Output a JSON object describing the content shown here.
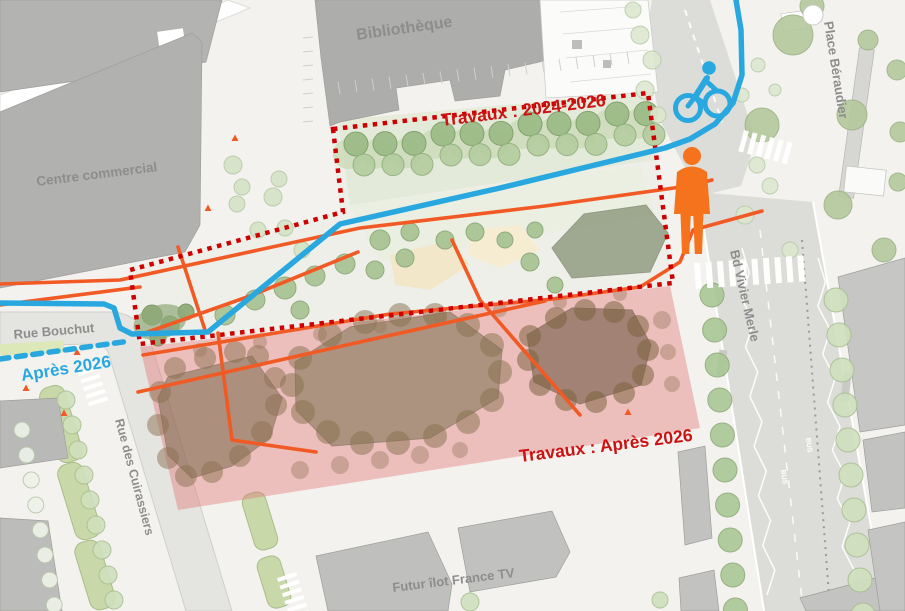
{
  "map": {
    "title": "Plan des travaux - secteur Part-Dieu",
    "labels": {
      "bibliotheque": "Bibliothèque",
      "centre_commercial": "Centre commercial",
      "place_beraudier": "Place Béraudier",
      "bd_vivier_merle": "Bd Vivier Merle",
      "rue_bouchut": "Rue Bouchut",
      "rue_des_cuirassiers": "Rue des Cuirassiers",
      "futur_ilot_france_tv": "Futur îlot France TV",
      "bus_lane": "BUS"
    },
    "annotations": {
      "phase1_label": "Travaux : 2024-2026",
      "phase2_label": "Travaux : Après 2026",
      "cycle_path_future_label": "Après 2026"
    },
    "icons": {
      "cyclist": "cyclist-icon",
      "pedestrian": "pedestrian-icon"
    },
    "colors": {
      "cycle_blue": "#29a8e0",
      "path_orange": "#f15a24",
      "works_red": "#cc0000",
      "works_label_red": "#cc1212",
      "phase2_pink_overlay": "#e07070",
      "building_gray": "#b1b1b1",
      "street_gray": "#dcdcd9",
      "tree_green": "#9dbc87",
      "grove_brown": "#6f6242",
      "label_gray": "#8f8f8f"
    }
  }
}
